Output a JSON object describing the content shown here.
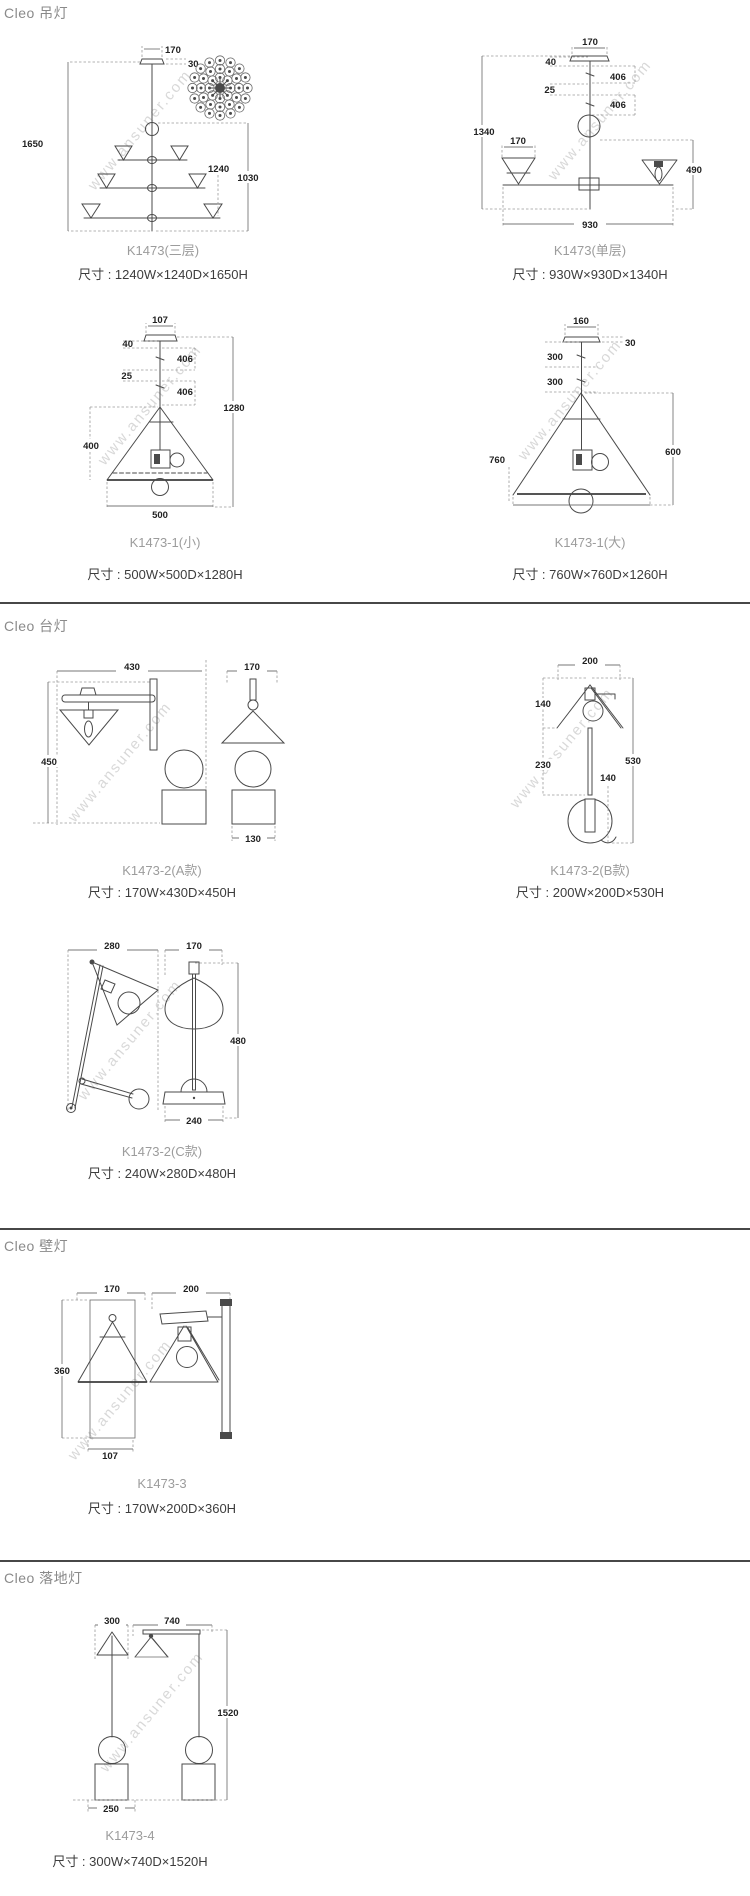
{
  "page": {
    "watermark": "www.ansuner.com"
  },
  "sections": [
    {
      "header": "Cleo 吊灯",
      "figures": [
        {
          "model": "K1473(三层)",
          "size": "尺寸 : 1240W×1240D×1650H",
          "d": {
            "a": "170",
            "b": "30",
            "c": "1650",
            "e": "1240",
            "f": "1030"
          }
        },
        {
          "model": "K1473(单层)",
          "size": "尺寸 : 930W×930D×1340H",
          "d": {
            "a": "170",
            "b": "40",
            "c": "406",
            "e": "25",
            "f": "406",
            "g": "1340",
            "h": "170",
            "i": "490",
            "j": "930"
          }
        },
        {
          "model": "K1473-1(小)",
          "size": "尺寸 : 500W×500D×1280H",
          "d": {
            "a": "107",
            "b": "40",
            "c": "406",
            "e": "25",
            "f": "406",
            "g": "1280",
            "h": "400",
            "i": "500"
          }
        },
        {
          "model": "K1473-1(大)",
          "size": "尺寸 : 760W×760D×1260H",
          "d": {
            "a": "160",
            "b": "30",
            "c": "300",
            "e": "300",
            "f": "760",
            "g": "600"
          }
        }
      ]
    },
    {
      "header": "Cleo 台灯",
      "figures": [
        {
          "model": "K1473-2(A款)",
          "size": "尺寸 : 170W×430D×450H",
          "d": {
            "a": "430",
            "b": "170",
            "c": "450",
            "e": "130"
          }
        },
        {
          "model": "K1473-2(B款)",
          "size": "尺寸 : 200W×200D×530H",
          "d": {
            "a": "200",
            "b": "140",
            "c": "230",
            "e": "530",
            "f": "140"
          }
        },
        {
          "model": "K1473-2(C款)",
          "size": "尺寸 : 240W×280D×480H",
          "d": {
            "a": "280",
            "b": "170",
            "c": "480",
            "e": "240"
          }
        }
      ]
    },
    {
      "header": "Cleo 壁灯",
      "figures": [
        {
          "model": "K1473-3",
          "size": "尺寸 : 170W×200D×360H",
          "d": {
            "a": "170",
            "b": "200",
            "c": "360",
            "e": "107"
          }
        }
      ]
    },
    {
      "header": "Cleo 落地灯",
      "figures": [
        {
          "model": "K1473-4",
          "size": "尺寸 : 300W×740D×1520H",
          "d": {
            "a": "300",
            "b": "740",
            "c": "1520",
            "e": "250"
          }
        }
      ]
    }
  ]
}
